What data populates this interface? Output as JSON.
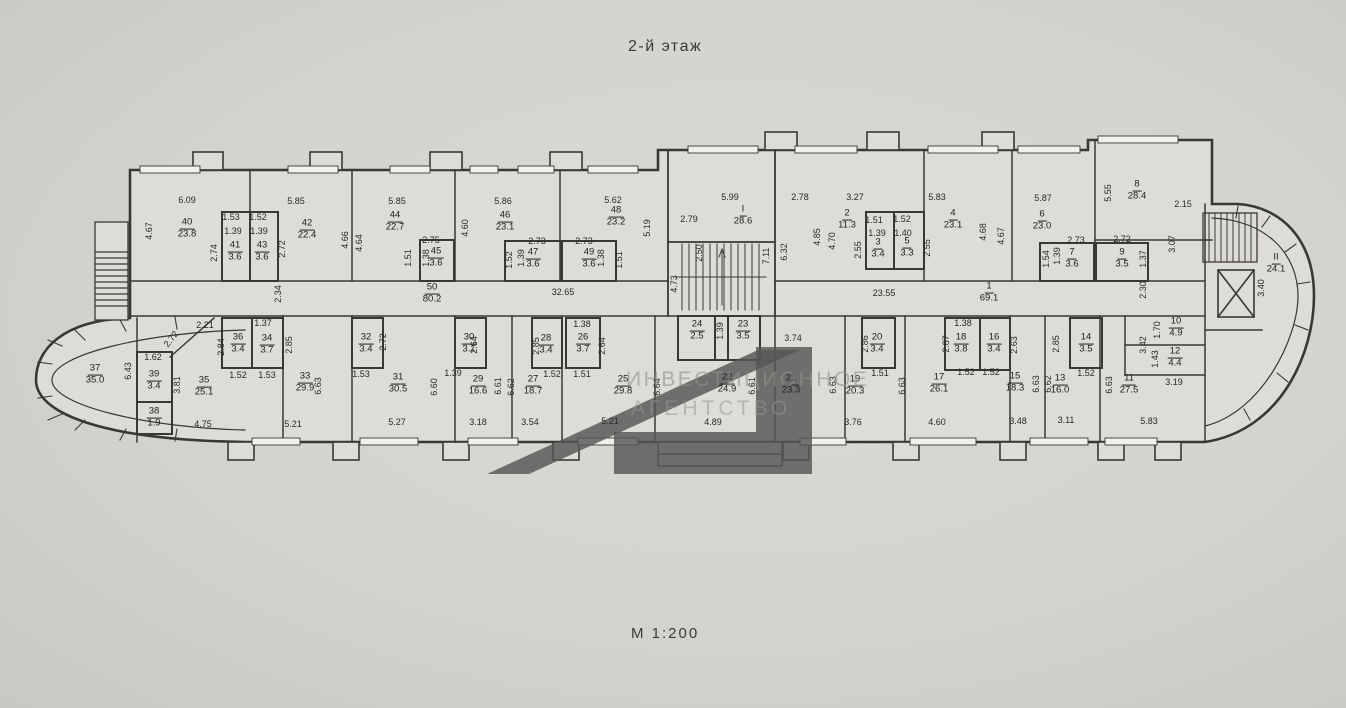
{
  "title": "2-й этаж",
  "scale_label": "М 1:200",
  "watermark": {
    "line1": "ИНВЕСТИЦИОННОЕ",
    "line2": "АГЕНТСТВО"
  },
  "colors": {
    "paper": "#d5d3cf",
    "wall_line": "#3a3835",
    "watermark_logo": "#5a5856"
  },
  "plan": {
    "rooms": [
      {
        "n": "40",
        "a": "23.8",
        "x": 187,
        "y": 229
      },
      {
        "n": "41",
        "a": "3.6",
        "x": 235,
        "y": 252
      },
      {
        "n": "43",
        "a": "3.6",
        "x": 262,
        "y": 252
      },
      {
        "n": "42",
        "a": "22.4",
        "x": 307,
        "y": 230
      },
      {
        "n": "44",
        "a": "22.7",
        "x": 395,
        "y": 222
      },
      {
        "n": "45",
        "a": "3.6",
        "x": 436,
        "y": 258
      },
      {
        "n": "46",
        "a": "23.1",
        "x": 505,
        "y": 222
      },
      {
        "n": "47",
        "a": "3.6",
        "x": 533,
        "y": 259
      },
      {
        "n": "49",
        "a": "3.6",
        "x": 589,
        "y": 259
      },
      {
        "n": "48",
        "a": "23.2",
        "x": 616,
        "y": 217
      },
      {
        "n": "I",
        "a": "28.6",
        "x": 743,
        "y": 216
      },
      {
        "n": "2",
        "a": "11.3",
        "x": 847,
        "y": 220
      },
      {
        "n": "3",
        "a": "3.4",
        "x": 878,
        "y": 249
      },
      {
        "n": "5",
        "a": "3.3",
        "x": 907,
        "y": 248
      },
      {
        "n": "4",
        "a": "23.1",
        "x": 953,
        "y": 220
      },
      {
        "n": "6",
        "a": "23.0",
        "x": 1042,
        "y": 221
      },
      {
        "n": "7",
        "a": "3.6",
        "x": 1072,
        "y": 259
      },
      {
        "n": "9",
        "a": "3.5",
        "x": 1122,
        "y": 259
      },
      {
        "n": "8",
        "a": "28.4",
        "x": 1137,
        "y": 191
      },
      {
        "n": "II",
        "a": "24.1",
        "x": 1276,
        "y": 264
      },
      {
        "n": "50",
        "a": "80.2",
        "x": 432,
        "y": 294
      },
      {
        "n": "1",
        "a": "69.1",
        "x": 989,
        "y": 293
      },
      {
        "n": "37",
        "a": "35.0",
        "x": 95,
        "y": 375
      },
      {
        "n": "39",
        "a": "3.4",
        "x": 154,
        "y": 381
      },
      {
        "n": "38",
        "a": "1.9",
        "x": 154,
        "y": 418
      },
      {
        "n": "35",
        "a": "25.1",
        "x": 204,
        "y": 387
      },
      {
        "n": "36",
        "a": "3.4",
        "x": 238,
        "y": 344
      },
      {
        "n": "34",
        "a": "3.7",
        "x": 267,
        "y": 345
      },
      {
        "n": "33",
        "a": "29.9",
        "x": 305,
        "y": 383
      },
      {
        "n": "32",
        "a": "3.4",
        "x": 366,
        "y": 344
      },
      {
        "n": "31",
        "a": "30.5",
        "x": 398,
        "y": 384
      },
      {
        "n": "30",
        "a": "3.1",
        "x": 469,
        "y": 344
      },
      {
        "n": "29",
        "a": "16.6",
        "x": 478,
        "y": 386
      },
      {
        "n": "27",
        "a": "18.7",
        "x": 533,
        "y": 386
      },
      {
        "n": "28",
        "a": "3.4",
        "x": 546,
        "y": 345
      },
      {
        "n": "26",
        "a": "3.7",
        "x": 583,
        "y": 344
      },
      {
        "n": "25",
        "a": "29.8",
        "x": 623,
        "y": 386
      },
      {
        "n": "24",
        "a": "2.5",
        "x": 697,
        "y": 331
      },
      {
        "n": "23",
        "a": "3.5",
        "x": 743,
        "y": 331
      },
      {
        "n": "22",
        "a": "24.9",
        "x": 727,
        "y": 384
      },
      {
        "n": "21",
        "a": "23.3",
        "x": 791,
        "y": 385
      },
      {
        "n": "19",
        "a": "20.3",
        "x": 855,
        "y": 386
      },
      {
        "n": "20",
        "a": "3.4",
        "x": 877,
        "y": 344
      },
      {
        "n": "17",
        "a": "26.1",
        "x": 939,
        "y": 384
      },
      {
        "n": "18",
        "a": "3.8",
        "x": 961,
        "y": 344
      },
      {
        "n": "16",
        "a": "3.4",
        "x": 994,
        "y": 344
      },
      {
        "n": "15",
        "a": "18.3",
        "x": 1015,
        "y": 383
      },
      {
        "n": "13",
        "a": "16.0",
        "x": 1060,
        "y": 385
      },
      {
        "n": "14",
        "a": "3.5",
        "x": 1086,
        "y": 344
      },
      {
        "n": "11",
        "a": "27.5",
        "x": 1129,
        "y": 385
      },
      {
        "n": "10",
        "a": "4.9",
        "x": 1176,
        "y": 328
      },
      {
        "n": "12",
        "a": "4.4",
        "x": 1175,
        "y": 358
      }
    ],
    "dims": [
      {
        "v": "6.09",
        "x": 187,
        "y": 200
      },
      {
        "v": "4.67",
        "x": 149,
        "y": 231,
        "r": 90
      },
      {
        "v": "1.53",
        "x": 231,
        "y": 217
      },
      {
        "v": "1.52",
        "x": 258,
        "y": 217
      },
      {
        "v": "1.39",
        "x": 233,
        "y": 231
      },
      {
        "v": "1.39",
        "x": 259,
        "y": 231
      },
      {
        "v": "2.74",
        "x": 214,
        "y": 253,
        "r": 90
      },
      {
        "v": "2.72",
        "x": 282,
        "y": 249,
        "r": 90
      },
      {
        "v": "5.85",
        "x": 296,
        "y": 201
      },
      {
        "v": "4.66",
        "x": 345,
        "y": 240,
        "r": 90
      },
      {
        "v": "4.64",
        "x": 359,
        "y": 243,
        "r": 90
      },
      {
        "v": "5.85",
        "x": 397,
        "y": 201
      },
      {
        "v": "2.75",
        "x": 431,
        "y": 240
      },
      {
        "v": "1.51",
        "x": 408,
        "y": 258,
        "r": 90
      },
      {
        "v": "1.38",
        "x": 426,
        "y": 258,
        "r": 90
      },
      {
        "v": "4.60",
        "x": 465,
        "y": 228,
        "r": 90
      },
      {
        "v": "5.86",
        "x": 503,
        "y": 201
      },
      {
        "v": "2.73",
        "x": 537,
        "y": 241
      },
      {
        "v": "1.52",
        "x": 509,
        "y": 260,
        "r": 90
      },
      {
        "v": "1.39",
        "x": 521,
        "y": 258,
        "r": 90
      },
      {
        "v": "2.73",
        "x": 584,
        "y": 241
      },
      {
        "v": "1.38",
        "x": 601,
        "y": 258,
        "r": 90
      },
      {
        "v": "1.51",
        "x": 619,
        "y": 260,
        "r": 90
      },
      {
        "v": "5.62",
        "x": 613,
        "y": 200
      },
      {
        "v": "5.19",
        "x": 647,
        "y": 228,
        "r": 90
      },
      {
        "v": "2.79",
        "x": 689,
        "y": 219
      },
      {
        "v": "2.50",
        "x": 699,
        "y": 253,
        "r": 90
      },
      {
        "v": "7.11",
        "x": 766,
        "y": 256,
        "r": 90
      },
      {
        "v": "6.32",
        "x": 784,
        "y": 252,
        "r": 90
      },
      {
        "v": "4.73",
        "x": 674,
        "y": 284,
        "r": 90
      },
      {
        "v": "5.99",
        "x": 730,
        "y": 197
      },
      {
        "v": "2.78",
        "x": 800,
        "y": 197
      },
      {
        "v": "3.27",
        "x": 855,
        "y": 197
      },
      {
        "v": "4.85",
        "x": 817,
        "y": 237,
        "r": 90
      },
      {
        "v": "4.70",
        "x": 832,
        "y": 241,
        "r": 90
      },
      {
        "v": "1.51",
        "x": 874,
        "y": 220
      },
      {
        "v": "1.52",
        "x": 902,
        "y": 219
      },
      {
        "v": "1.39",
        "x": 877,
        "y": 233
      },
      {
        "v": "1.40",
        "x": 903,
        "y": 233
      },
      {
        "v": "2.55",
        "x": 858,
        "y": 250,
        "r": 90
      },
      {
        "v": "2.55",
        "x": 927,
        "y": 248,
        "r": 90
      },
      {
        "v": "5.83",
        "x": 937,
        "y": 197
      },
      {
        "v": "4.68",
        "x": 983,
        "y": 232,
        "r": 90
      },
      {
        "v": "4.67",
        "x": 1001,
        "y": 236,
        "r": 90
      },
      {
        "v": "5.87",
        "x": 1043,
        "y": 198
      },
      {
        "v": "2.73",
        "x": 1076,
        "y": 240
      },
      {
        "v": "2.72",
        "x": 1122,
        "y": 239
      },
      {
        "v": "1.54",
        "x": 1046,
        "y": 259,
        "r": 90
      },
      {
        "v": "1.39",
        "x": 1057,
        "y": 256,
        "r": 90
      },
      {
        "v": "1.37",
        "x": 1143,
        "y": 259,
        "r": 90
      },
      {
        "v": "5.55",
        "x": 1108,
        "y": 193,
        "r": 90
      },
      {
        "v": "2.15",
        "x": 1183,
        "y": 204
      },
      {
        "v": "3.07",
        "x": 1172,
        "y": 244,
        "r": 90
      },
      {
        "v": "3.40",
        "x": 1261,
        "y": 288,
        "r": 90
      },
      {
        "v": "2.34",
        "x": 278,
        "y": 294,
        "r": 90
      },
      {
        "v": "32.65",
        "x": 563,
        "y": 292
      },
      {
        "v": "23.55",
        "x": 884,
        "y": 293
      },
      {
        "v": "2.30",
        "x": 1143,
        "y": 290,
        "r": 90
      },
      {
        "v": "2.21",
        "x": 205,
        "y": 325
      },
      {
        "v": "2.72",
        "x": 171,
        "y": 339,
        "r": 52
      },
      {
        "v": "1.62",
        "x": 153,
        "y": 357
      },
      {
        "v": "6.43",
        "x": 128,
        "y": 371,
        "r": 90
      },
      {
        "v": "3.81",
        "x": 177,
        "y": 385,
        "r": 90
      },
      {
        "v": "4.75",
        "x": 203,
        "y": 424
      },
      {
        "v": "2.84",
        "x": 221,
        "y": 347,
        "r": 90
      },
      {
        "v": "1.37",
        "x": 263,
        "y": 323
      },
      {
        "v": "2.85",
        "x": 289,
        "y": 345,
        "r": 90
      },
      {
        "v": "1.52",
        "x": 238,
        "y": 375
      },
      {
        "v": "1.53",
        "x": 267,
        "y": 375
      },
      {
        "v": "6.63",
        "x": 318,
        "y": 386,
        "r": 90
      },
      {
        "v": "5.21",
        "x": 293,
        "y": 424
      },
      {
        "v": "2.72",
        "x": 383,
        "y": 342,
        "r": 90
      },
      {
        "v": "1.53",
        "x": 361,
        "y": 374
      },
      {
        "v": "6.60",
        "x": 434,
        "y": 387,
        "r": 90
      },
      {
        "v": "5.27",
        "x": 397,
        "y": 422
      },
      {
        "v": "2.64",
        "x": 474,
        "y": 345,
        "r": 90
      },
      {
        "v": "1.39",
        "x": 453,
        "y": 373
      },
      {
        "v": "6.61",
        "x": 498,
        "y": 386,
        "r": 90
      },
      {
        "v": "6.62",
        "x": 511,
        "y": 387,
        "r": 90
      },
      {
        "v": "3.18",
        "x": 478,
        "y": 422
      },
      {
        "v": "3.54",
        "x": 530,
        "y": 422
      },
      {
        "v": "2.85",
        "x": 536,
        "y": 346,
        "r": 90
      },
      {
        "v": "1.52",
        "x": 552,
        "y": 374
      },
      {
        "v": "1.38",
        "x": 582,
        "y": 324
      },
      {
        "v": "2.64",
        "x": 602,
        "y": 346,
        "r": 90
      },
      {
        "v": "1.51",
        "x": 582,
        "y": 374
      },
      {
        "v": "6.64",
        "x": 657,
        "y": 387,
        "r": 90
      },
      {
        "v": "5.21",
        "x": 610,
        "y": 421
      },
      {
        "v": "1.39",
        "x": 720,
        "y": 331,
        "r": 90
      },
      {
        "v": "3.74",
        "x": 793,
        "y": 338
      },
      {
        "v": "4.89",
        "x": 713,
        "y": 422
      },
      {
        "v": "6.61",
        "x": 752,
        "y": 386,
        "r": 90
      },
      {
        "v": "6.63",
        "x": 833,
        "y": 385,
        "r": 90
      },
      {
        "v": "3.76",
        "x": 853,
        "y": 422
      },
      {
        "v": "2.86",
        "x": 865,
        "y": 344,
        "r": 90
      },
      {
        "v": "1.51",
        "x": 880,
        "y": 373
      },
      {
        "v": "6.63",
        "x": 902,
        "y": 386,
        "r": 90
      },
      {
        "v": "4.60",
        "x": 937,
        "y": 422
      },
      {
        "v": "1.38",
        "x": 963,
        "y": 323
      },
      {
        "v": "2.87",
        "x": 946,
        "y": 344,
        "r": 90
      },
      {
        "v": "1.52",
        "x": 966,
        "y": 372
      },
      {
        "v": "2.63",
        "x": 1014,
        "y": 345,
        "r": 90
      },
      {
        "v": "1.52",
        "x": 991,
        "y": 372
      },
      {
        "v": "6.63",
        "x": 1036,
        "y": 384,
        "r": 90
      },
      {
        "v": "3.48",
        "x": 1018,
        "y": 421
      },
      {
        "v": "6.62",
        "x": 1048,
        "y": 384,
        "r": 90
      },
      {
        "v": "3.11",
        "x": 1066,
        "y": 420
      },
      {
        "v": "2.85",
        "x": 1056,
        "y": 344,
        "r": 90
      },
      {
        "v": "1.52",
        "x": 1086,
        "y": 373
      },
      {
        "v": "6.63",
        "x": 1109,
        "y": 385,
        "r": 90
      },
      {
        "v": "5.83",
        "x": 1149,
        "y": 421
      },
      {
        "v": "1.70",
        "x": 1157,
        "y": 330,
        "r": 90
      },
      {
        "v": "3.42",
        "x": 1143,
        "y": 345,
        "r": 90
      },
      {
        "v": "1.43",
        "x": 1155,
        "y": 359,
        "r": 90
      },
      {
        "v": "3.19",
        "x": 1174,
        "y": 382
      }
    ]
  }
}
